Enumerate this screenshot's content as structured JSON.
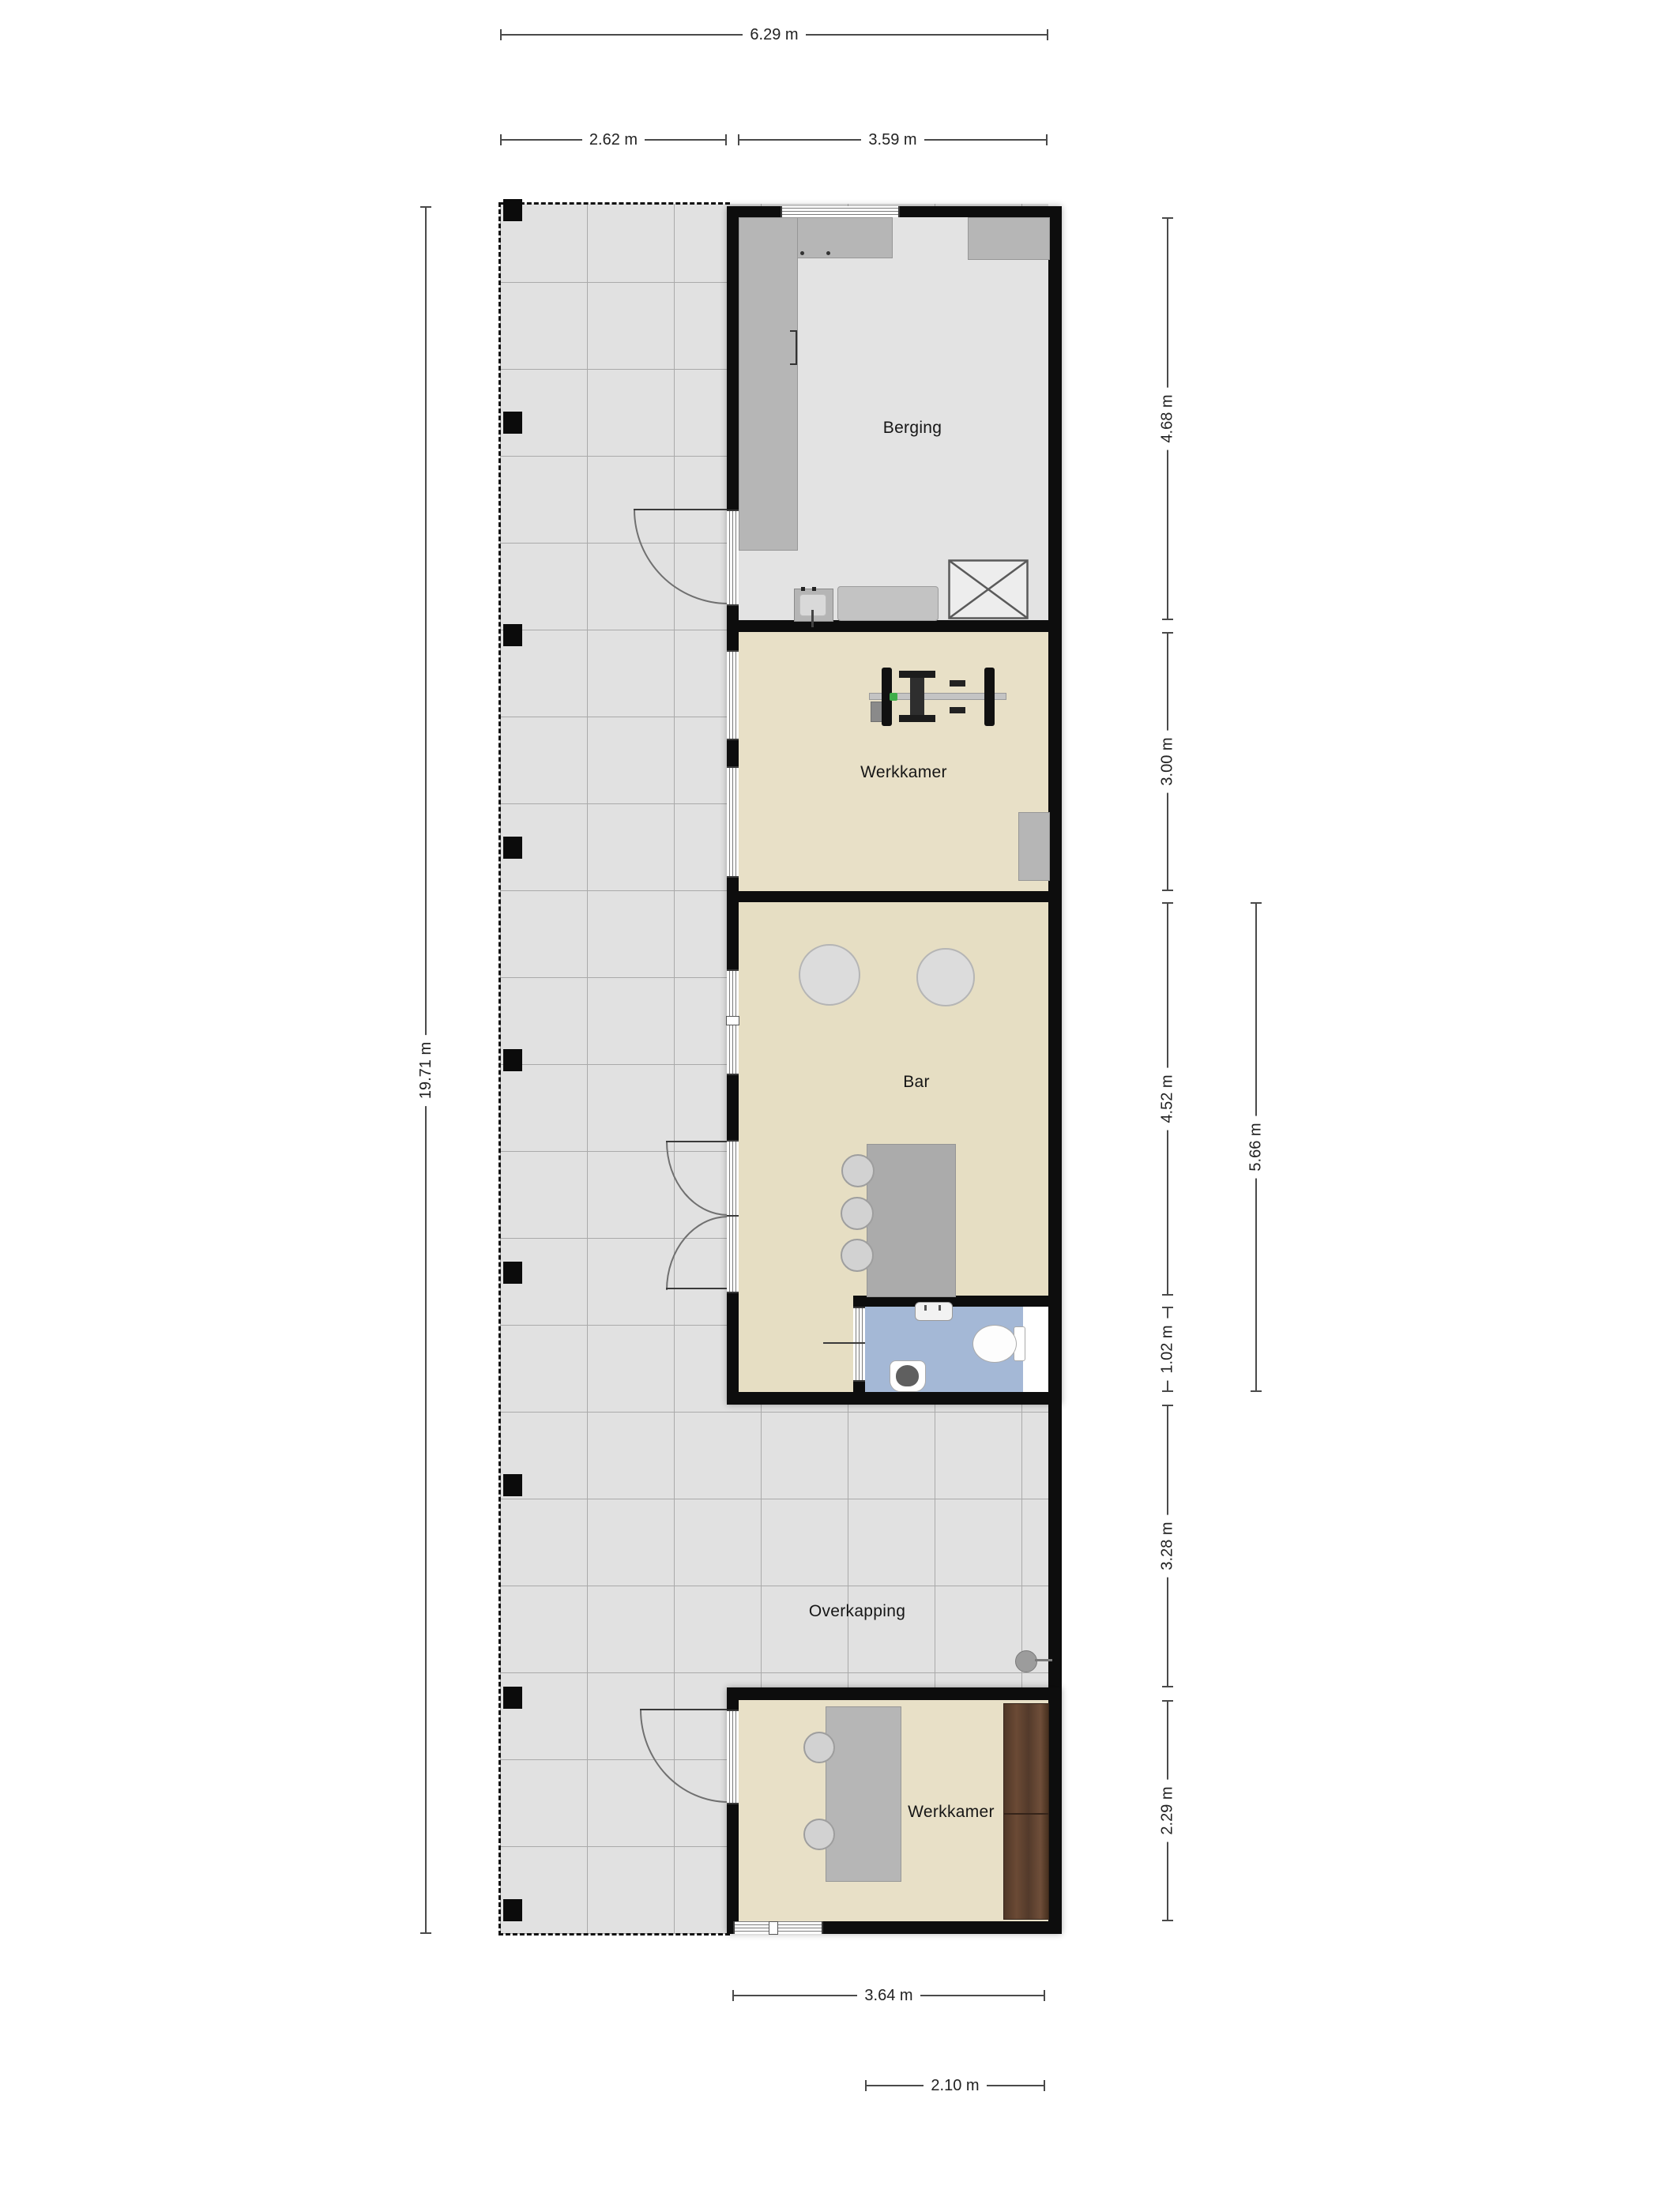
{
  "plan_type": "floorplan",
  "rooms": {
    "berging": {
      "label": "Berging",
      "floor_color": "#e3e3e3"
    },
    "werkkamer_top": {
      "label": "Werkkamer",
      "floor_color": "#e8e0c7"
    },
    "bar": {
      "label": "Bar",
      "floor_color": "#e6dec3"
    },
    "toilet": {
      "floor_color": "#a4b8d6"
    },
    "overkapping": {
      "label": "Overkapping",
      "floor_color": "#e1e1e1"
    },
    "werkkamer_bottom": {
      "label": "Werkkamer",
      "floor_color": "#e8e0c7"
    }
  },
  "dimensions": {
    "top_total": "6.29 m",
    "top_left": "2.62 m",
    "top_right": "3.59 m",
    "left_total": "19.71 m",
    "right_berging": "4.68 m",
    "right_werkkamer": "3.00 m",
    "right_bar": "4.52 m",
    "right_toilet": "1.02 m",
    "right_overkapping": "3.28 m",
    "right_werkkamer2": "2.29 m",
    "right_bar_total": "5.66 m",
    "bottom_inner": "3.64 m",
    "bottom_offset": "2.10 m"
  },
  "colors": {
    "wall": "#0d0d0d",
    "terrace_floor": "#e1e1e1",
    "grid_line": "#aaaaaa",
    "dimension_line": "#4a4a4a",
    "counter_gray": "#b6b6b6",
    "bar_counter": "#ababab",
    "wardrobe_wood": "#5b4334",
    "toilet_floor": "#a4b8d6",
    "accent_green": "#3fae4a"
  }
}
